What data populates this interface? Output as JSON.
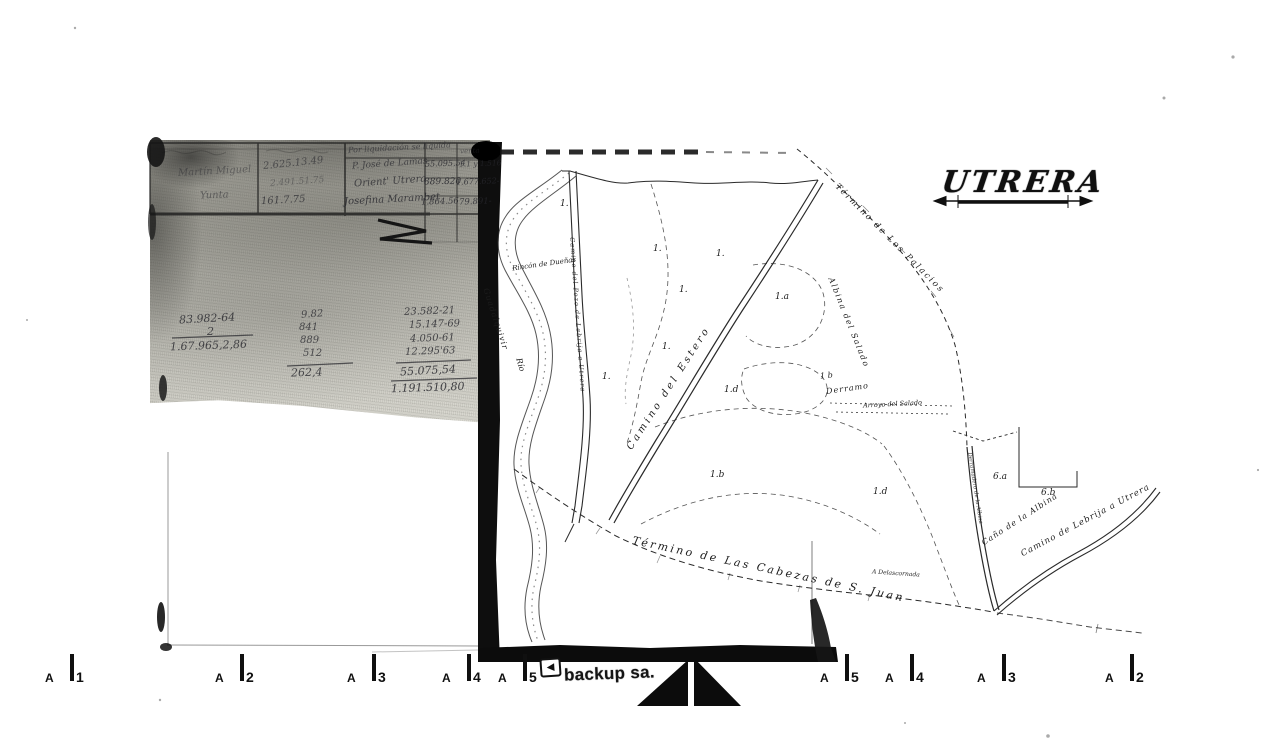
{
  "title": {
    "text": "UTRERA"
  },
  "logo": {
    "brand": "backup sa."
  },
  "ruler": {
    "prefix": "A",
    "left": [
      "1",
      "2",
      "3",
      "4",
      "5"
    ],
    "right": [
      "5",
      "4",
      "3",
      "2"
    ]
  },
  "ledger": {
    "col1": [
      "Martín Miguel",
      "Yunta"
    ],
    "col2": [
      "2.625.13.49",
      "2.491.51.75",
      "161.7.75"
    ],
    "col3_header": "Por liquidación se liquida",
    "col3": [
      "P. José de Lamas",
      "Orient' Utrera",
      "Josefina Marambet"
    ],
    "col4": [
      "55.095.54",
      "889.820",
      "1.864.56"
    ],
    "col5_header": "venta",
    "col5": [
      "1.1 y 1.516",
      "1.677.652-",
      "79.891-"
    ]
  },
  "sums": {
    "col1": [
      "83.982-64",
      "2",
      "1.67.965,2,86"
    ],
    "col2": [
      "9.82",
      "841",
      "889",
      "512",
      "262,4"
    ],
    "col3": [
      "23.582-21",
      "15.147-69",
      "4.050-61",
      "12.295'63",
      "55.075,54",
      "1.191.510,80"
    ]
  },
  "map": {
    "labels": {
      "rincon": "Rincón de Dueñas",
      "guadalquivir": "Guadalquivir",
      "rio": "Río",
      "camino_pozo": "Camino del Pozo de Lebrija a Utrera",
      "camino_estero": "Camino del Estero",
      "termino_palacios": "Término de Los Palacios",
      "albina_salado": "Albina del Salado",
      "arroyo_salado": "Arroyo del Salado",
      "derramo_num": "1 b",
      "derramo": "Derramo",
      "termino_cabezas": "Término de Las Cabezas de S. Juan",
      "delascornada": "A Delascornada",
      "cano_albina": "Caño de la Albina",
      "camino_lebrija": "Camino de Lebrija a Utrera",
      "derramadero": "Derramadero de la Albina"
    },
    "parcels": [
      "1.",
      "1.",
      "1.",
      "1.",
      "1.",
      "1.",
      "1.a",
      "1.d",
      "1.b",
      "1.d",
      "6.a",
      "6.b"
    ]
  }
}
